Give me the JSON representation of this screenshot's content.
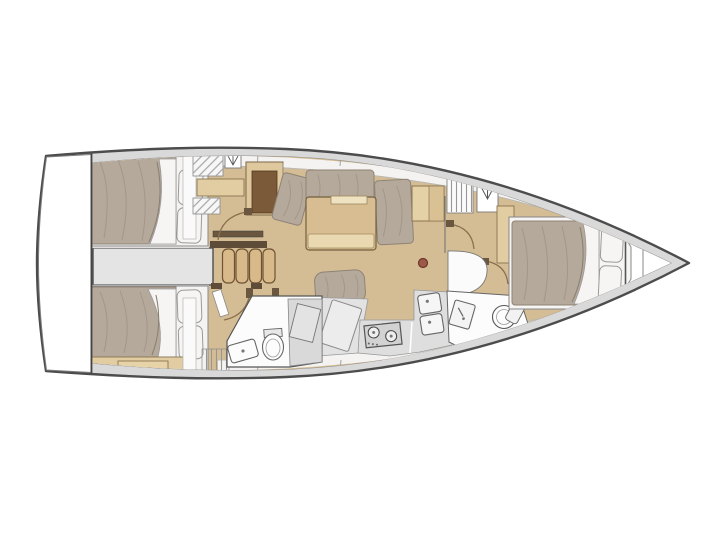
{
  "meta": {
    "title": "Sailing yacht interior layout plan — top-down view, bow to the right, 3 cabins and 2 heads"
  },
  "colors": {
    "background": "#ffffff",
    "hull_outline": "#4c4c4c",
    "deck_fill": "#d9d9d9",
    "interior_white": "#faf9f7",
    "white": "#ffffff",
    "wood_floor": "#d4bd94",
    "wood_shelf": "#e2cda2",
    "wood_dark_panel": "#7b5a39",
    "wood_table": "#d9bd92",
    "wood_leaf": "#e9d8b0",
    "stair_tread": "#d8b98a",
    "stair_rail": "#5f4c38",
    "mattress": "#b5a99b",
    "pillow": "#f6f5f3",
    "bed_frame": "#f4f3f1",
    "gray_corridor": "#e4e4e4",
    "gray_counter": "#dedede",
    "stove": "#d2d2d2",
    "fixture": "#fcfcfc",
    "door_arc": "#8a6f4e",
    "mast_post": "#9c5a49"
  },
  "rooms": [
    {
      "id": "transom-swim-platform",
      "label": "stern swim platform"
    },
    {
      "id": "aft-cabin-port",
      "label": "aft double cabin (top)"
    },
    {
      "id": "aft-cabin-starboard",
      "label": "aft double cabin (bottom)"
    },
    {
      "id": "companionway",
      "label": "companionway stairs and engine compartment"
    },
    {
      "id": "salon",
      "label": "salon with settee and folding table"
    },
    {
      "id": "aft-heads",
      "label": "aft heads with shower"
    },
    {
      "id": "galley",
      "label": "galley with stove and double sink"
    },
    {
      "id": "forward-heads",
      "label": "forward heads"
    },
    {
      "id": "forward-cabin",
      "label": "forward double cabin"
    },
    {
      "id": "bow-locker",
      "label": "anchor / chain locker"
    }
  ],
  "symbols": {
    "hanging_locker": "V-with-stem wardrobe symbol",
    "shelf_hatch": "diagonal hatched shelving",
    "slatted_locker": "vertical slat locker",
    "mast_post": "red compression post dot"
  }
}
